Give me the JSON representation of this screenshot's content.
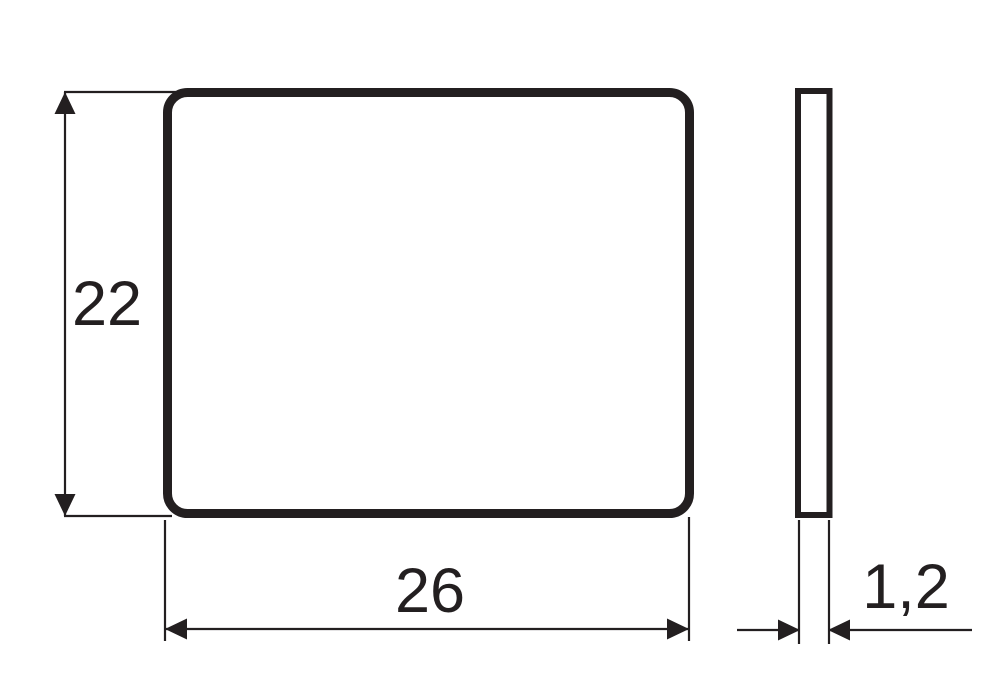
{
  "drawing": {
    "kind": "technical-dimension-drawing",
    "views": {
      "front": "front-view-plate",
      "side": "side-view-thickness-profile"
    },
    "dimensions": {
      "height": "22",
      "width": "26",
      "thickness": "1,2"
    },
    "colors": {
      "line": "#231f20",
      "background": "#ffffff"
    }
  }
}
